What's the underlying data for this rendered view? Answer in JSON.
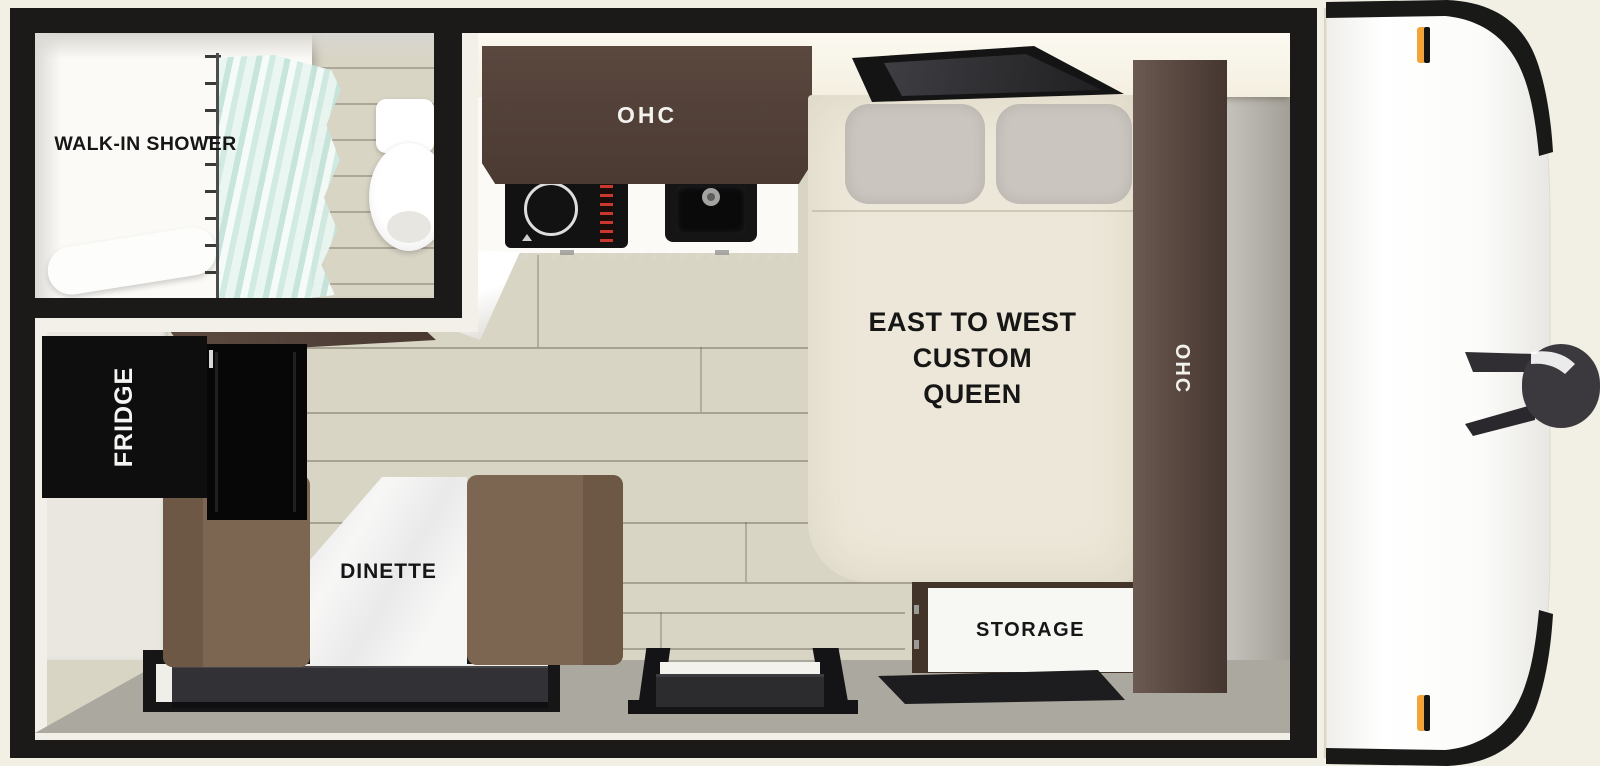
{
  "labels": {
    "bathroom": "WALK-IN SHOWER",
    "kitchen_overhead_cabinet": "OHC",
    "fridge": "FRIDGE",
    "dinette": "DINETTE",
    "bed_line1": "EAST TO WEST",
    "bed_line2": "CUSTOM",
    "bed_line3": "QUEEN",
    "bedside_overhead_cabinet": "OHC",
    "storage": "STORAGE"
  },
  "colors": {
    "background_cream": "#f2efe4",
    "frame_black": "#1b1a18",
    "floor_wood": "#d9d5c5",
    "cabinet_wood_brown": "#56453b",
    "bench_brown": "#7c6652",
    "bed_cream": "#ece7d8",
    "pillow_gray": "#cac5be",
    "wall_gray": "#aba89f",
    "curtain_teal": "#cfe9e1",
    "marker_light_amber": "#f2a43a"
  }
}
